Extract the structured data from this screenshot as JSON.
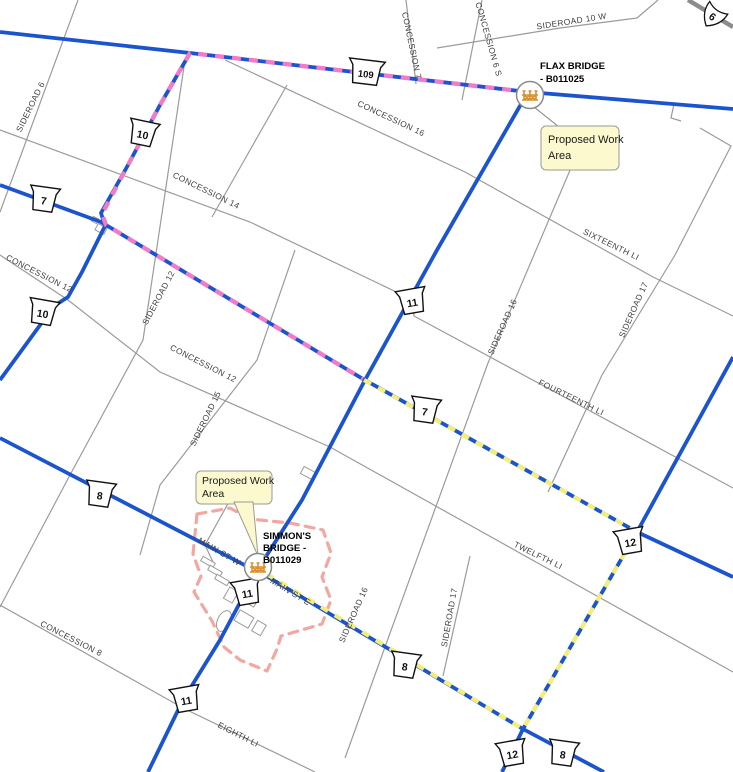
{
  "colors": {
    "highway_blue": "#1c54ce",
    "detour_pink": "#f07cc8",
    "detour_yellow": "#f3ee7b",
    "work_area_outline": "#f2a7a0",
    "minor_road_gray": "#9b9b9b",
    "provincial_road_gray": "#8c8c8c",
    "bridge_icon_orange": "#d98f2e",
    "callout_fill": "#fbf9cd",
    "callout_border": "#9a9a9a"
  },
  "road_labels": {
    "sideroad_6": "SIDEROAD 6",
    "concession_6s": "CONCESSION 6 S",
    "concession_7": "CONCESSION 7",
    "sideroad_10w": "SIDEROAD 10 W",
    "concession_16": "CONCESSION 16",
    "concession_14": "CONCESSION 14",
    "concession_12_west": "CONCESSION 12",
    "concession_12_mid": "CONCESSION 12",
    "sideroad_12": "SIDEROAD 12",
    "sideroad_15": "SIDEROAD 15",
    "sixteenth_line": "SIXTEENTH LI",
    "sideroad_16_north": "SIDEROAD 16",
    "sideroad_17_north": "SIDEROAD 17",
    "fourteenth_line": "FOURTEENTH LI",
    "twelfth_line": "TWELFTH LI",
    "sideroad_16_south": "SIDEROAD 16",
    "sideroad_17_south": "SIDEROAD 17",
    "main_st_w": "MAIN ST W",
    "main_st_e": "MAIN ST E",
    "concession_8": "CONCESSION 8",
    "eighth_line": "EIGHTH LI"
  },
  "shields": {
    "hwy7_west": "7",
    "hwy10_north": "10",
    "hwy109": "109",
    "hwy10_south": "10",
    "hwy11_north": "11",
    "hwy7_mid": "7",
    "hwy8_west": "8",
    "hwy11_mid": "11",
    "hwy11_south": "11",
    "hwy12_north": "12",
    "hwy8_mid": "8",
    "hwy12_south": "12",
    "hwy8_south": "8",
    "hwy6": "6"
  },
  "bridges": {
    "flax": {
      "label_line1": "FLAX BRIDGE",
      "label_line2": "- B011025"
    },
    "simmons": {
      "label_line1": "SIMMON'S",
      "label_line2": "BRIDGE -",
      "label_line3": "B011029"
    }
  },
  "callouts": {
    "flax": {
      "line1": "Proposed Work",
      "line2": "Area"
    },
    "simmons": {
      "line1": "Proposed Work",
      "line2": "Area"
    }
  }
}
